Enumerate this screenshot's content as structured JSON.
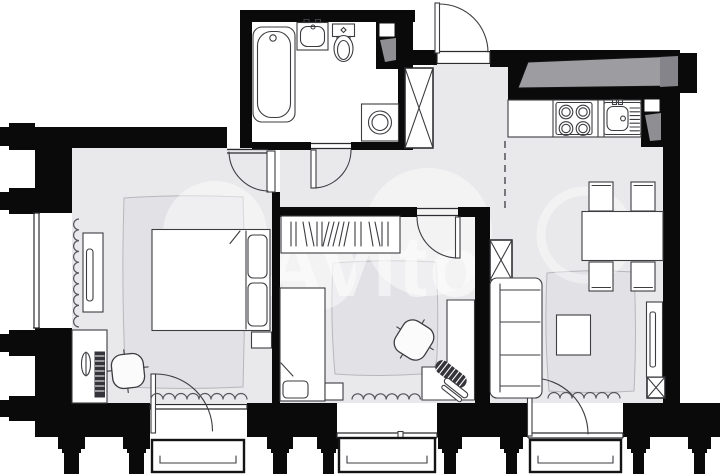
{
  "type": "floor-plan",
  "watermark": {
    "text": "Avito"
  },
  "palette": {
    "wall": "#0a0a0a",
    "floor": "#e9e9ec",
    "rug": "#e2e2e6",
    "line": "#3c3c41",
    "beam": "#9c9ca1",
    "beam_dark": "#84848a",
    "vent_gray": "#8e8e93",
    "balcony_border": "#141414",
    "watermark": "#ffffff"
  },
  "regions": {
    "list": [
      {
        "name": "bathroom"
      },
      {
        "name": "entry-hall"
      },
      {
        "name": "corridor"
      },
      {
        "name": "kitchen-living-dining"
      },
      {
        "name": "bedroom-1"
      },
      {
        "name": "bedroom-2"
      },
      {
        "name": "balcony-1"
      },
      {
        "name": "balcony-2"
      },
      {
        "name": "balcony-3"
      }
    ]
  },
  "fixtures": {
    "list": [
      "bathtub",
      "bathroom-sink",
      "toilet",
      "washing-machine",
      "vent-shaft",
      "entry-door",
      "cooktop-4-burner",
      "kitchen-sink",
      "kitchen-counter",
      "dining-table",
      "dining-chair",
      "sofa",
      "coffee-table",
      "tv-stand",
      "wardrobe-open",
      "double-bed",
      "single-bed",
      "desk",
      "office-chair",
      "monitor",
      "laptop",
      "radiator",
      "rug",
      "window",
      "balcony-door",
      "column",
      "pilaster"
    ]
  }
}
